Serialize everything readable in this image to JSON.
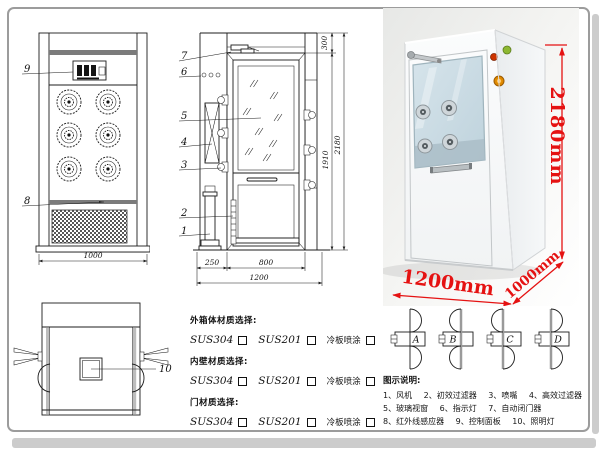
{
  "frame": {
    "border_color": "#9c9c9c",
    "band_color": "#cccccc"
  },
  "front_view": {
    "callout_control_panel": "9",
    "callout_grille": "8",
    "dim_width": "1000"
  },
  "section_view": {
    "callout_door_closer": "7",
    "callout_indicator": "6",
    "callout_glass": "5",
    "callout_hepa": "4",
    "callout_nozzle": "3",
    "callout_prefilter": "2",
    "callout_fan": "1",
    "dim_top": "300",
    "dim_door_height": "1910",
    "dim_total_height": "2180",
    "dim_left": "250",
    "dim_door_width": "800",
    "dim_total_width": "1200"
  },
  "top_view": {
    "callout_lamp": "10"
  },
  "photo": {
    "dim_height": "2180mm",
    "dim_width": "1200mm",
    "dim_depth": "1000mm",
    "dim_color": "#e51212",
    "light_green": "#8db832",
    "light_red": "#cc3300",
    "button_color": "#e08a00"
  },
  "door_options": {
    "a": "A",
    "b": "B",
    "c": "C",
    "d": "D"
  },
  "materials": {
    "sections": [
      {
        "title": "外箱体材质选择:",
        "options": [
          "SUS304",
          "SUS201",
          "冷板喷涂"
        ]
      },
      {
        "title": "内壁材质选择:",
        "options": [
          "SUS304",
          "SUS201",
          "冷板喷涂"
        ]
      },
      {
        "title": "门材质选择:",
        "options": [
          "SUS304",
          "SUS201",
          "冷板喷涂"
        ]
      }
    ]
  },
  "legend": {
    "title": "图示说明:",
    "items": [
      "1、风机",
      "2、初效过滤器",
      "3、喷嘴",
      "4、高效过滤器",
      "5、玻璃视窗",
      "6、指示灯",
      "7、自动闭门器",
      "8、红外线感应器",
      "9、控制面板",
      "10、照明灯"
    ]
  }
}
